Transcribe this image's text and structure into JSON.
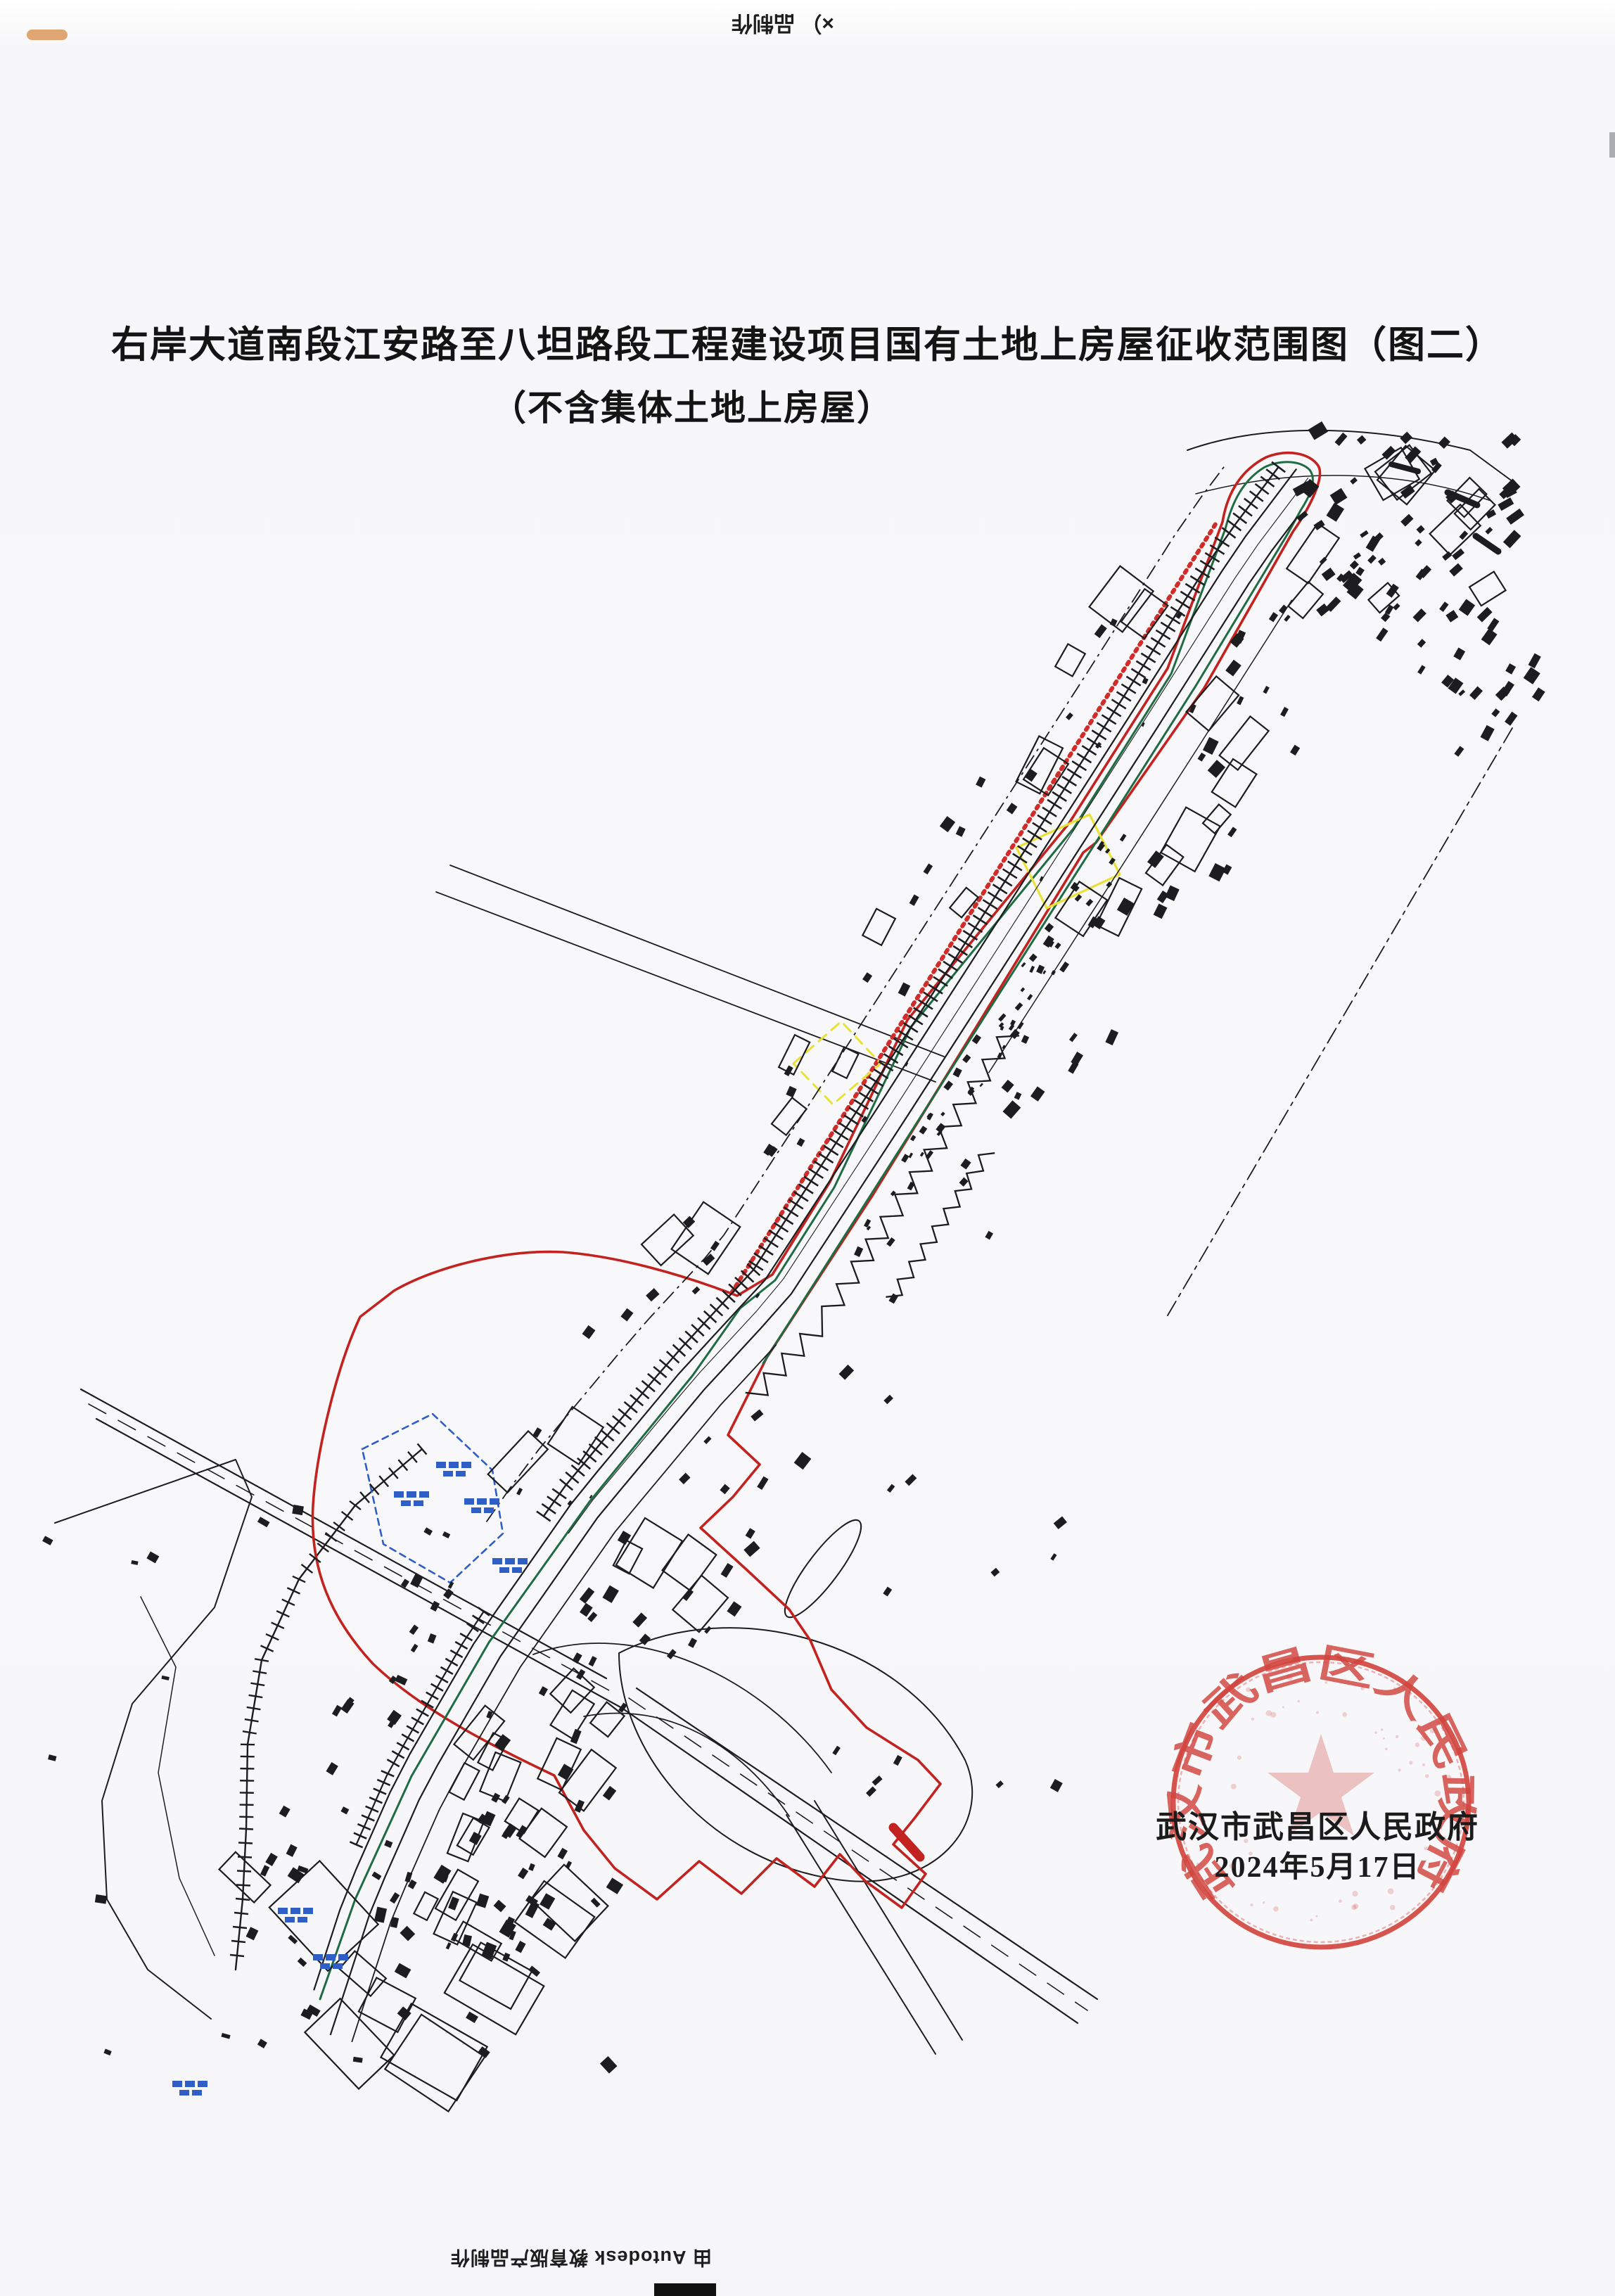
{
  "document": {
    "title_line1": "右岸大道南段江安路至八坦路段工程建设项目国有土地上房屋征收范围图（图二）",
    "title_line2": "（不含集体土地上房屋）"
  },
  "watermarks": {
    "top_fragment": "×） 品制作",
    "bottom": "由 Autodesk 教育版产品制作"
  },
  "seal": {
    "arc_text": "武汉市武昌区人民政府",
    "issuer": "武汉市武昌区人民政府",
    "date": "2024年5月17日"
  },
  "colors": {
    "ink": "#1d1d1f",
    "boundary_red": "#c22320",
    "boundary_red_dotted": "#d02d2a",
    "survey_green": "#1e6b44",
    "parcel_yellow": "#e9e138",
    "annotation_blue": "#2e5ec6",
    "seal_red": "#d2453f",
    "seal_text_black": "#1b1b1b",
    "smudge_orange": "#d9914f",
    "edge_gray": "#8a8f94"
  }
}
